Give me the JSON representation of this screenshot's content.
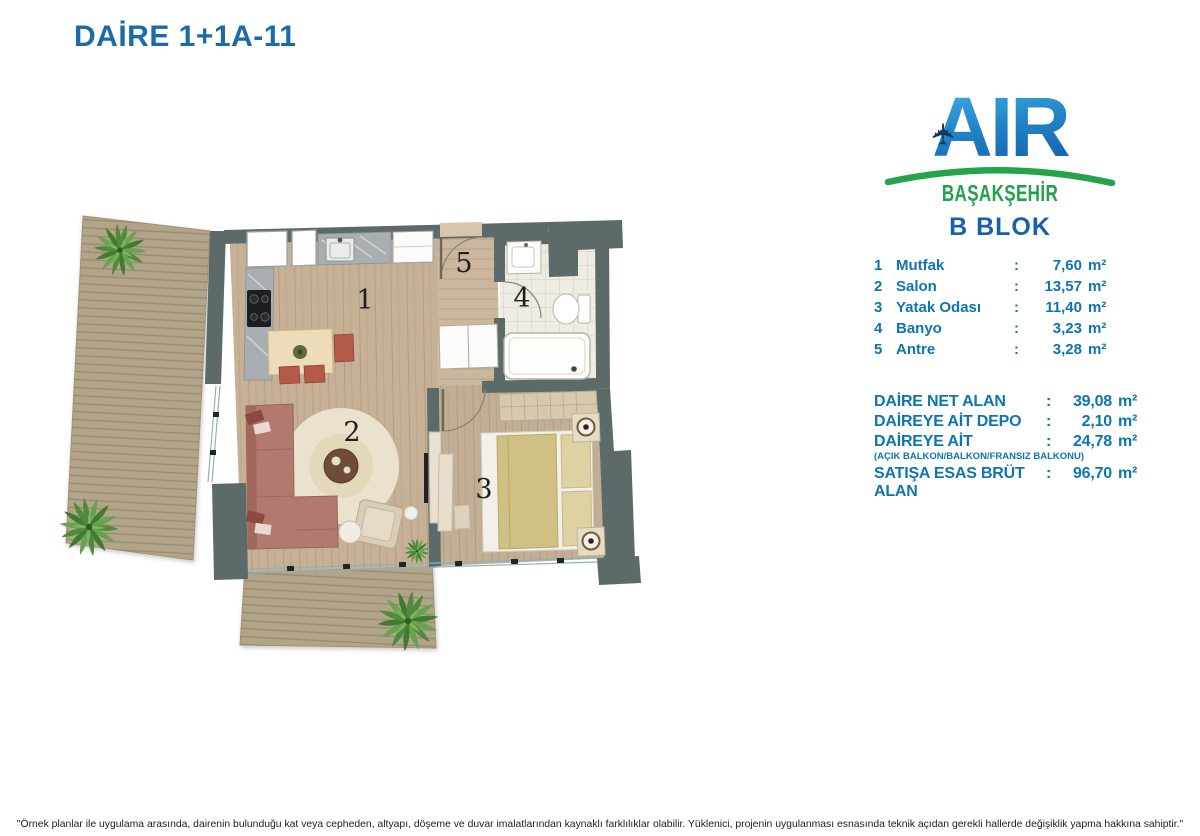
{
  "title": "DAİRE 1+1A-11",
  "logo": {
    "brand": "AIR",
    "subtitle": "BAŞAKŞEHİR",
    "block": "B BLOK",
    "airplane_icon": "airplane-icon"
  },
  "rooms": [
    {
      "no": "1",
      "name": "Mutfak",
      "sep": ":",
      "value": "7,60",
      "unit": "m²"
    },
    {
      "no": "2",
      "name": "Salon",
      "sep": ":",
      "value": "13,57",
      "unit": "m²"
    },
    {
      "no": "3",
      "name": "Yatak Odası",
      "sep": ":",
      "value": "11,40",
      "unit": "m²"
    },
    {
      "no": "4",
      "name": "Banyo",
      "sep": ":",
      "value": "3,23",
      "unit": "m²"
    },
    {
      "no": "5",
      "name": "Antre",
      "sep": ":",
      "value": "3,28",
      "unit": "m²"
    }
  ],
  "summary": [
    {
      "label": "DAİRE NET ALAN",
      "sep": ":",
      "value": "39,08",
      "unit": "m²",
      "note": ""
    },
    {
      "label": "DAİREYE AİT DEPO",
      "sep": ":",
      "value": "2,10",
      "unit": "m²",
      "note": ""
    },
    {
      "label": "DAİREYE AİT",
      "sep": ":",
      "value": "24,78",
      "unit": "m²",
      "note": "(AÇIK BALKON/BALKON/FRANSIZ BALKONU)"
    },
    {
      "label": "SATIŞA ESAS BRÜT ALAN",
      "sep": ":",
      "value": "96,70",
      "unit": "m²",
      "note": ""
    }
  ],
  "disclaimer": "\"Örnek planlar ile uygulama arasında, dairenin bulunduğu kat veya cepheden, altyapı, döşeme ve duvar imalatlarından kaynaklı farklılıklar olabilir. Yüklenici, projenin uygulanması esnasında teknik açıdan gerekli hallerde değişiklik yapma hakkına sahiptir.\"",
  "colors": {
    "title_blue": "#1c6ba8",
    "list_blue": "#0e74b2",
    "logo_green": "#21a14a",
    "logo_blue_light": "#45b6e8",
    "logo_blue_dark": "#1565ae",
    "wall_gray": "#5c6b6a",
    "wood_floor": "#c6b197",
    "deck_wood": "#b2a489",
    "sofa_rose": "#b27a6e",
    "rug_cream": "#eae2cc",
    "blanket_olive": "#cfc083"
  }
}
